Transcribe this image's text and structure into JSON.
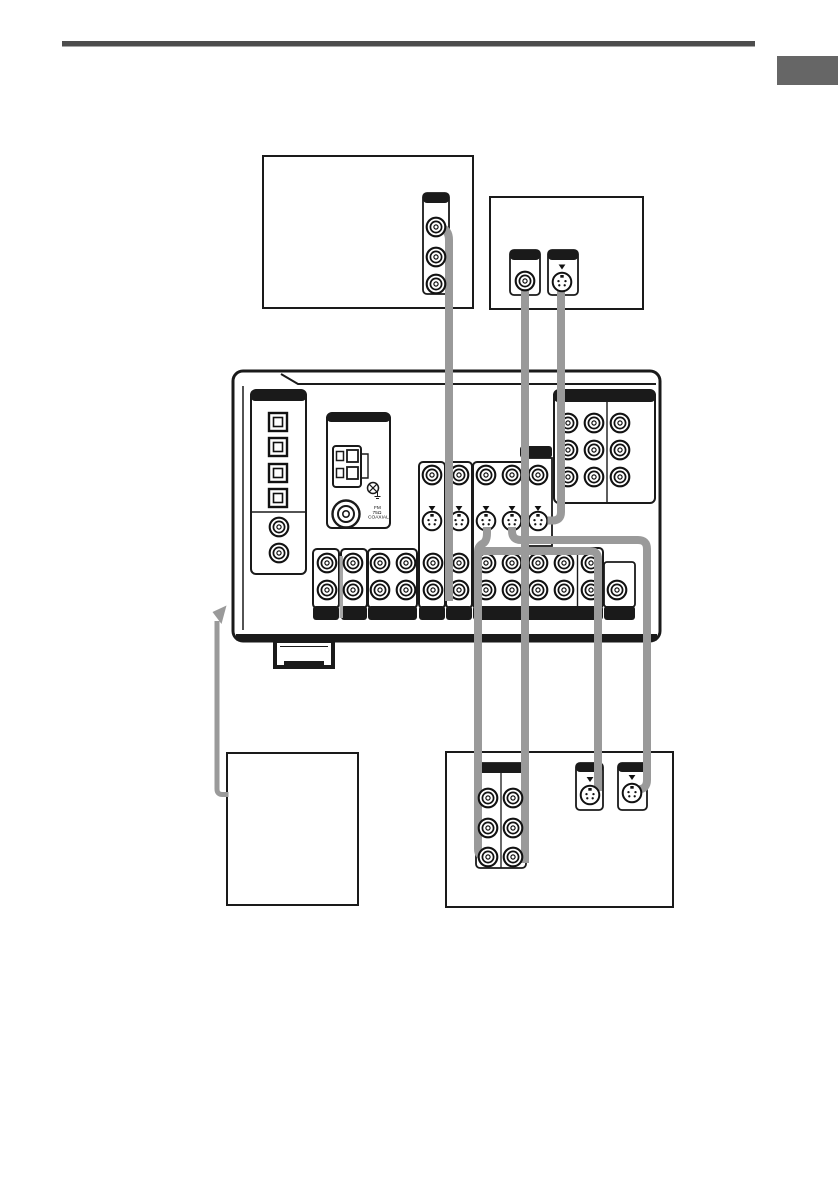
{
  "document": {
    "type": "audio-receiver-hookup-diagram-page",
    "description": "Manual page illustration: rear panel of AV receiver with cables to four component boxes"
  },
  "colors": {
    "ink": "#1a1a1a",
    "cable": "#9a9a9a",
    "rule": "#4d4d4d",
    "tab": "#666666",
    "paper": "#ffffff"
  },
  "receiver": {
    "fm_antenna_label": {
      "line1": "FM",
      "line2": "75Ω",
      "line3": "COAXIAL"
    }
  }
}
